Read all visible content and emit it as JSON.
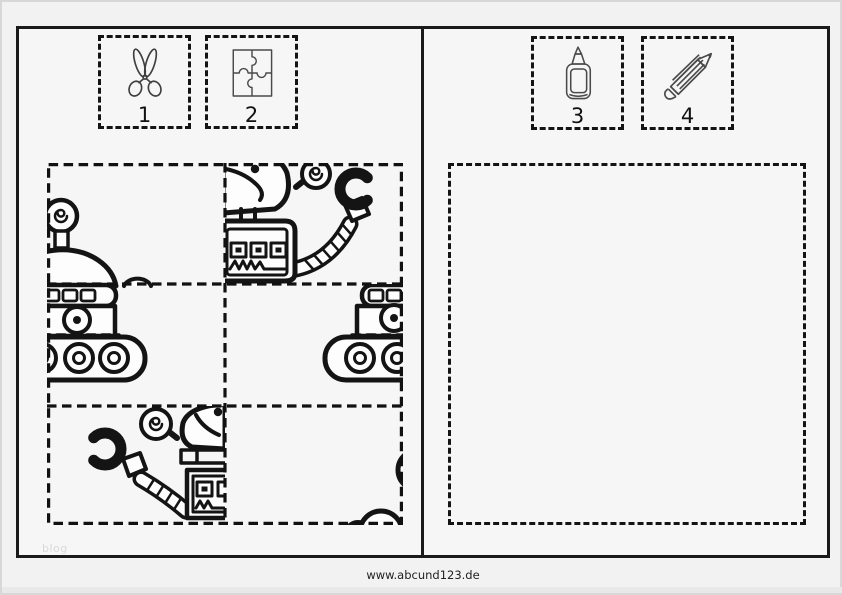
{
  "footer": {
    "url": "www.abcund123.de"
  },
  "watermark": {
    "text": "blog"
  },
  "left_page": {
    "steps": [
      {
        "number": "1",
        "icon": "scissors"
      },
      {
        "number": "2",
        "icon": "puzzle-pieces"
      }
    ],
    "puzzle_grid": {
      "rows": 3,
      "columns": 2,
      "pieces": [
        "robot-antenna-and-dome-fragment",
        "robot-head-with-claw-arm-right-fragment",
        "tank-tread-robot-left-fragment",
        "tank-tread-robot-right-edge-fragment",
        "robot-head-with-claw-arm-left-fragment",
        "tread-wheel-arcs-corner-fragment"
      ]
    }
  },
  "right_page": {
    "steps": [
      {
        "number": "3",
        "icon": "glue-bottle"
      },
      {
        "number": "4",
        "icon": "pencil"
      }
    ],
    "paste_area": {
      "content": ""
    }
  },
  "colors": {
    "line_art": "#141414",
    "page_background": "#f6f6f6",
    "canvas_background": "#f2f2f2",
    "watermark_text": "#d9d9d9",
    "footer_text": "#222222"
  }
}
